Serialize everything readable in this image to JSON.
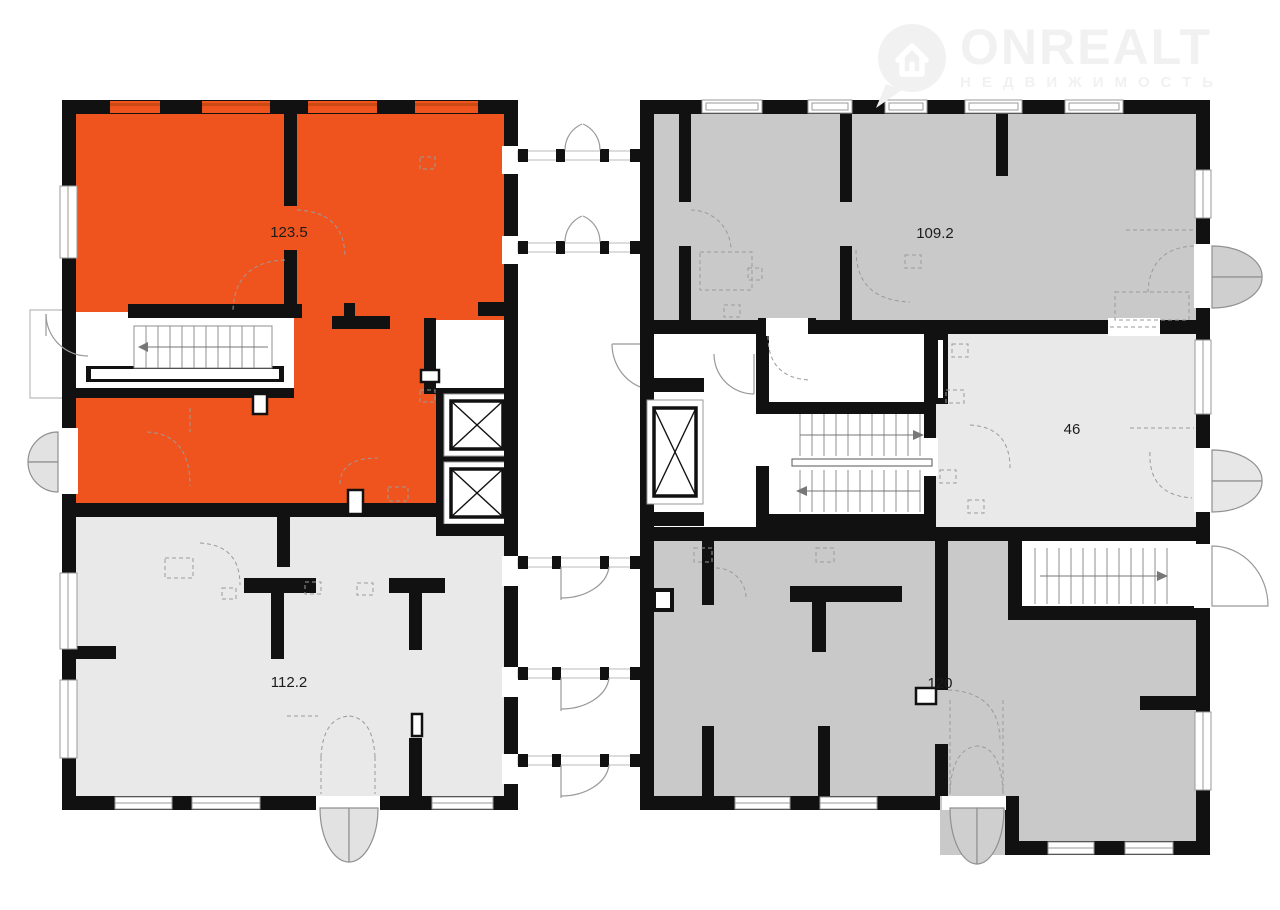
{
  "watermark": {
    "brand": "ONREALT",
    "subtitle": "НЕДВИЖИМОСТЬ"
  },
  "floor_plan": {
    "type": "floor-plan",
    "units": [
      {
        "id": "unit-123-5",
        "label": "123.5",
        "fill": "#F0541E",
        "highlighted": true,
        "building": "left",
        "location": "top"
      },
      {
        "id": "unit-112-2",
        "label": "112.2",
        "fill": "#E9E9E9",
        "highlighted": false,
        "building": "left",
        "location": "bottom"
      },
      {
        "id": "unit-109-2",
        "label": "109.2",
        "fill": "#C9C9C9",
        "highlighted": false,
        "building": "right",
        "location": "top"
      },
      {
        "id": "unit-46",
        "label": "46",
        "fill": "#E9E9E9",
        "highlighted": false,
        "building": "right",
        "location": "middle-right"
      },
      {
        "id": "unit-120",
        "label": "120",
        "fill": "#C9C9C9",
        "highlighted": false,
        "building": "right",
        "location": "bottom"
      }
    ],
    "colors": {
      "highlight_orange": "#F0541E",
      "window_sill_orange": "#C94A12",
      "unit_gray": "#C9C9C9",
      "unit_light_gray": "#E9E9E9",
      "wall_black": "#111111",
      "door_leaf_gray": "#E2E2E2",
      "line_gray": "#999999",
      "background": "#FFFFFF"
    }
  }
}
